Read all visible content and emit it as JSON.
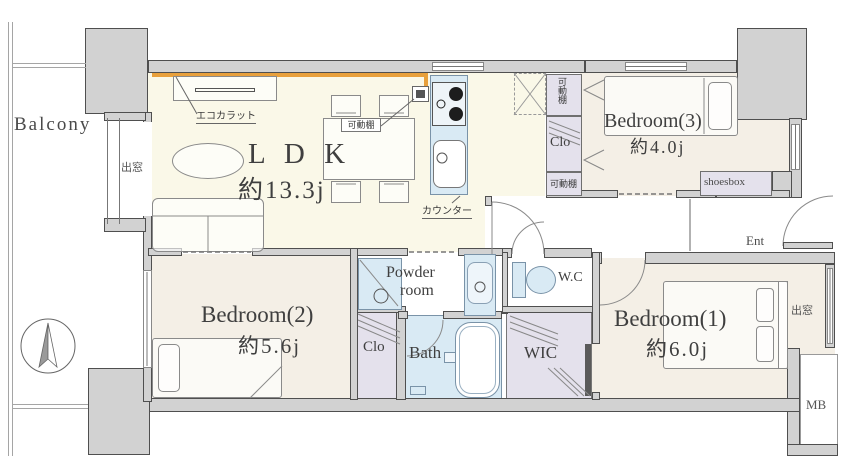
{
  "floorplan": {
    "balcony": "Balcony",
    "rooms": {
      "ldk": {
        "name": "L D K",
        "size": "約13.3j"
      },
      "bedroom1": {
        "name": "Bedroom(1)",
        "size": "約6.0j"
      },
      "bedroom2": {
        "name": "Bedroom(2)",
        "size": "約5.6j"
      },
      "bedroom3": {
        "name": "Bedroom(3)",
        "size": "約4.0j"
      },
      "powder_room": {
        "line1": "Powder",
        "line2": "room"
      },
      "bath": "Bath",
      "wic": "WIC",
      "wc": "W.C",
      "closet": "Clo"
    },
    "labels": {
      "movable_shelf": "可動棚",
      "ecocarat": "エコカラット",
      "counter": "カウンター",
      "bay_window": "出窓",
      "shoesbox": "shoesbox",
      "entrance": "Ent",
      "meter_box": "MB"
    },
    "colors": {
      "wall": "#d2d2d2",
      "ldk_floor": "#faf8e8",
      "bedroom_floor": "#f4efe6",
      "water_blue": "#d9eaf4",
      "closet_lavender": "#e4e1ec",
      "accent_orange": "#e8a03c"
    }
  }
}
